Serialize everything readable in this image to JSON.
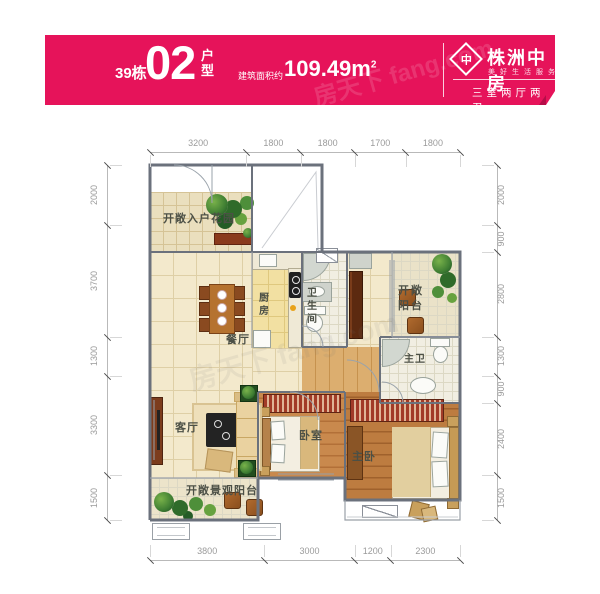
{
  "banner": {
    "bg_color": "#e6135a",
    "block": "39栋",
    "unit": "02",
    "unit_type": "户型",
    "area_label": "建筑面积约",
    "area_value": "109.49",
    "area_unit": "m",
    "area_sup": "2",
    "logo_glyph": "中",
    "brand": "株洲中房",
    "brand_tagline": "美好生活服务商",
    "layout_tag": "三室两厅两卫",
    "watermark": "房天下 fang.com"
  },
  "plan": {
    "rooms": {
      "garden": "开敞入户花园",
      "dining": "餐厅",
      "kitchen": "厨房",
      "bathroom": "卫生间",
      "balcony_top": "开敞阳台",
      "master_bath": "主卫",
      "bedroom": "卧室",
      "master_bedroom": "主卧",
      "living": "客厅",
      "balcony_bottom": "开敞景观阳台"
    },
    "dimensions": {
      "top": [
        "3200",
        "1800",
        "1800",
        "1700",
        "1800"
      ],
      "bottom": [
        "3800",
        "3000",
        "1200",
        "2300"
      ],
      "left": [
        "2000",
        "3700",
        "1300",
        "3300",
        "1500"
      ],
      "right": [
        "2000",
        "900",
        "2800",
        "1300",
        "900",
        "2400",
        "1500"
      ]
    },
    "watermark": "房天下 fang.com"
  }
}
